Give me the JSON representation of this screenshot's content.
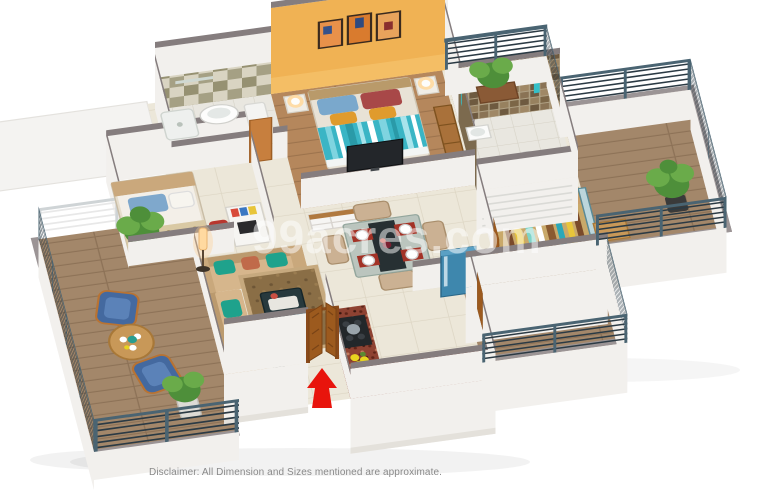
{
  "watermark": "99acres.com",
  "disclaimer": "Disclaimer: All Dimension and Sizes mentioned are approximate.",
  "icons": {
    "entrance_arrow": "up-arrow"
  },
  "palette": {
    "bg": "#ffffff",
    "wall_cap": "#857d7e",
    "wall_light": "#f2f0ed",
    "wall_shade": "#e2dfda",
    "orange_wall": "#f0b254",
    "tile_cream": "#ece7d9",
    "tile_line": "#dcd5c3",
    "tile_bath": "#e9e7e0",
    "wood_floor": "#b5875c",
    "wood_floor_dk": "#9c734d",
    "wood_balcony": "#a3876a",
    "wood_balcony_dk": "#8d7257",
    "granite": "#8e4232",
    "granite_dk": "#5e2418",
    "counter_face": "#7a3a2a",
    "sofa": "#d6b68c",
    "sofa_dk": "#bb9a6e",
    "teal": "#1fa28c",
    "rug": "#8a6e46",
    "rug_border": "#c6a97e",
    "blue_chair": "#44699f",
    "blue_chair_lt": "#5b82b8",
    "wood_trim": "#b87333",
    "door_wood": "#9c5a1e",
    "door_wood_dk": "#7a4416",
    "arrow_red": "#e8140c",
    "railing": "#4a6472",
    "railing_bar": "#2b3a44",
    "plant": "#4e8f3a",
    "plant_lt": "#6aab4a",
    "olive_tile": "#8f8a6a",
    "olive_tile_bg": "#d9d4c2",
    "mosaic_brown": "#8a7355",
    "bed_teal": "#3ab5c5",
    "bed_teal_lt": "#7fd4e0",
    "fridge_blue": "#3e87ad",
    "sink_blue": "#4887a5",
    "lamp_glow": "#ffd9a0",
    "tv_dark": "#23262a",
    "text_gray": "#8a8a8a",
    "watermark_color": "#ffffff"
  }
}
